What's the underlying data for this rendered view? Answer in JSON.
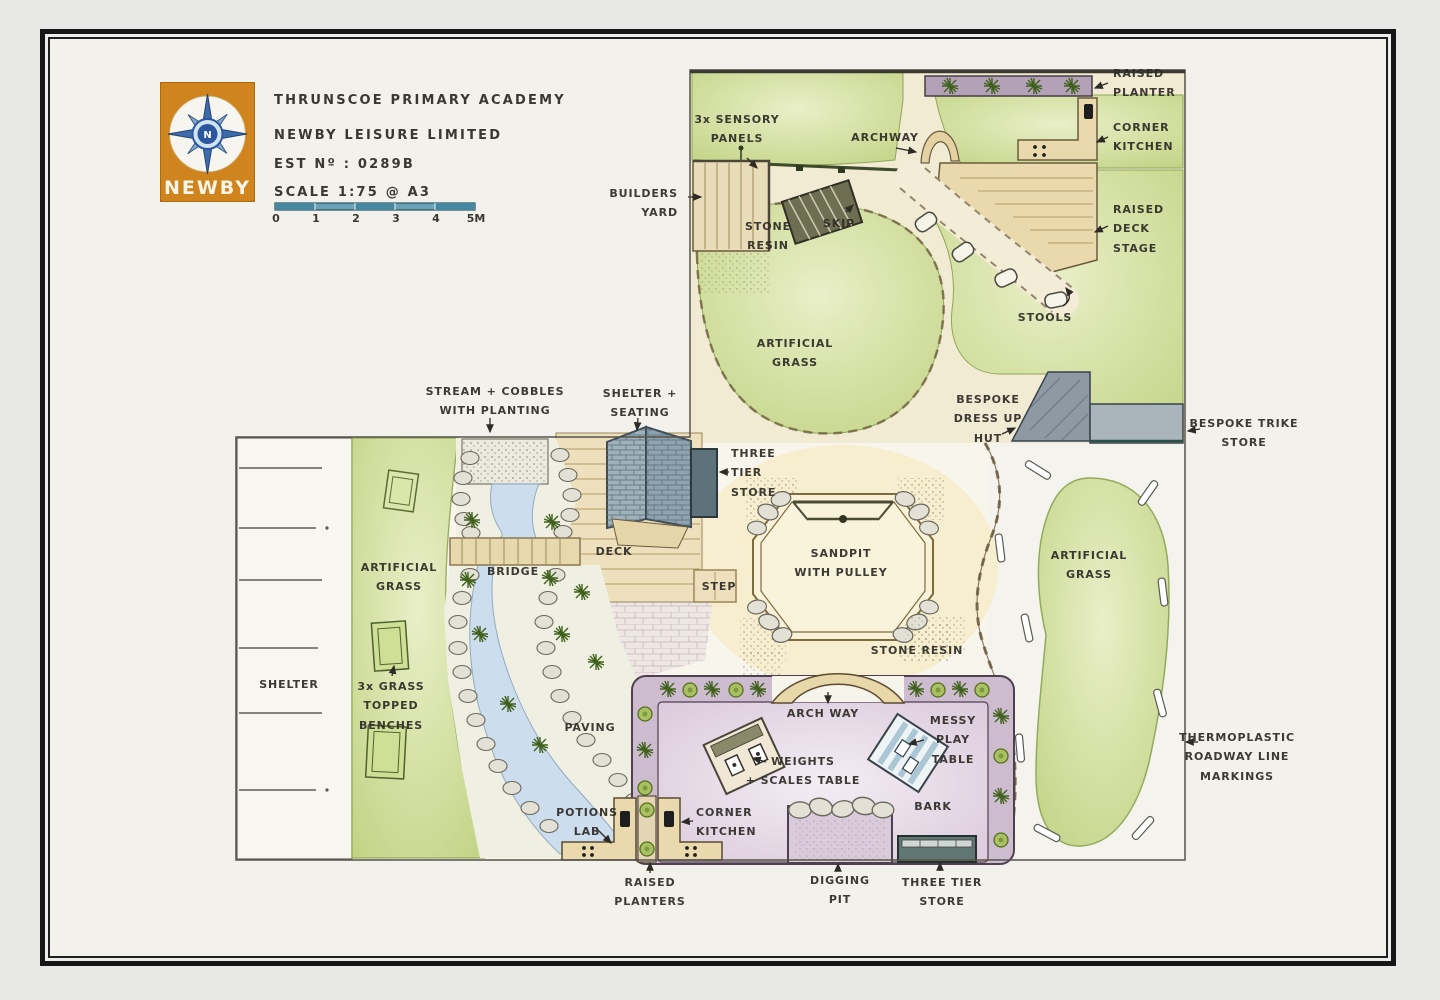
{
  "page": {
    "background": "#e8e8e6",
    "paper": "#f2f1ec",
    "frame_color": "#161616"
  },
  "title_block": {
    "logo_text": "NEWBY",
    "logo_letter": "N",
    "line1": "THRUNSCOE PRIMARY ACADEMY",
    "line2": "NEWBY LEISURE LIMITED",
    "line3": "EST Nº : 0289B",
    "line4": "SCALE 1:75 @ A3",
    "scale_ticks": [
      "0",
      "1",
      "2",
      "3",
      "4",
      "5M"
    ]
  },
  "colors": {
    "grass": "#cdda92",
    "grass_dark": "#8fa757",
    "stone_resin": "#f2ebd3",
    "wood": "#ead9ad",
    "bark_border": "#cdbccf",
    "bark_fill": "#ece0ed",
    "roof_slate": "#9fb2bc",
    "store_slate": "#5e727b",
    "store_teal": "#5f7673",
    "stream_blue": "#ccdded",
    "ink": "#2e2b26",
    "logo_orange": "#d0841e",
    "logo_blue": "#3d6cab",
    "scalebar_teal": "#4688a0"
  },
  "plan": {
    "labels": [
      {
        "id": "sensory-panels",
        "text": "3x SENSORY\nPANELS",
        "x": 737,
        "y": 110,
        "align": "center"
      },
      {
        "id": "archway-top",
        "text": "ARCHWAY",
        "x": 885,
        "y": 128,
        "align": "center"
      },
      {
        "id": "raised-planter",
        "text": "RAISED\nPLANTER",
        "x": 1113,
        "y": 64,
        "align": "left"
      },
      {
        "id": "corner-kitchen-top",
        "text": "CORNER\nKITCHEN",
        "x": 1113,
        "y": 118,
        "align": "left"
      },
      {
        "id": "raised-deck-stage",
        "text": "RAISED\nDECK\nSTAGE",
        "x": 1113,
        "y": 200,
        "align": "left"
      },
      {
        "id": "builders-yard",
        "text": "BUILDERS\nYARD",
        "x": 678,
        "y": 184,
        "align": "right"
      },
      {
        "id": "stone-resin-top",
        "text": "STONE\nRESIN",
        "x": 768,
        "y": 217,
        "align": "center"
      },
      {
        "id": "skip",
        "text": "SKIP",
        "x": 839,
        "y": 214,
        "align": "center"
      },
      {
        "id": "stools",
        "text": "STOOLS",
        "x": 1045,
        "y": 308,
        "align": "center"
      },
      {
        "id": "artificial-grass-top",
        "text": "ARTIFICIAL\nGRASS",
        "x": 795,
        "y": 334,
        "align": "center"
      },
      {
        "id": "dress-up-hut",
        "text": "BESPOKE\nDRESS UP\nHUT",
        "x": 988,
        "y": 390,
        "align": "center"
      },
      {
        "id": "trike-store",
        "text": "BESPOKE TRIKE\nSTORE",
        "x": 1244,
        "y": 414,
        "align": "center"
      },
      {
        "id": "stream-cobbles",
        "text": "STREAM + COBBLES\nWITH PLANTING",
        "x": 495,
        "y": 382,
        "align": "center"
      },
      {
        "id": "shelter-seating",
        "text": "SHELTER +\nSEATING",
        "x": 640,
        "y": 384,
        "align": "center"
      },
      {
        "id": "three-tier-store-top",
        "text": "THREE\nTIER\nSTORE",
        "x": 731,
        "y": 444,
        "align": "left"
      },
      {
        "id": "deck",
        "text": "DECK",
        "x": 614,
        "y": 542,
        "align": "center"
      },
      {
        "id": "step",
        "text": "STEP",
        "x": 719,
        "y": 577,
        "align": "center"
      },
      {
        "id": "sandpit",
        "text": "SANDPIT\nWITH PULLEY",
        "x": 841,
        "y": 544,
        "align": "center"
      },
      {
        "id": "artificial-grass-right",
        "text": "ARTIFICIAL\nGRASS",
        "x": 1089,
        "y": 546,
        "align": "center"
      },
      {
        "id": "bridge",
        "text": "BRIDGE",
        "x": 513,
        "y": 562,
        "align": "center"
      },
      {
        "id": "stone-resin-mid",
        "text": "STONE RESIN",
        "x": 917,
        "y": 641,
        "align": "center"
      },
      {
        "id": "shelter-left",
        "text": "SHELTER",
        "x": 289,
        "y": 675,
        "align": "center"
      },
      {
        "id": "artificial-grass-left",
        "text": "ARTIFICIAL\nGRASS",
        "x": 399,
        "y": 558,
        "align": "center"
      },
      {
        "id": "grass-benches",
        "text": "3x GRASS\nTOPPED\nBENCHES",
        "x": 391,
        "y": 677,
        "align": "center"
      },
      {
        "id": "paving",
        "text": "PAVING",
        "x": 590,
        "y": 718,
        "align": "center"
      },
      {
        "id": "archway-bottom",
        "text": "ARCH WAY",
        "x": 823,
        "y": 704,
        "align": "center"
      },
      {
        "id": "messy-play-table",
        "text": "MESSY\nPLAY\nTABLE",
        "x": 953,
        "y": 711,
        "align": "center"
      },
      {
        "id": "weights-scales-table",
        "text": "WEIGHTS\n+ SCALES TABLE",
        "x": 803,
        "y": 752,
        "align": "center"
      },
      {
        "id": "potions-lab",
        "text": "POTIONS\nLAB",
        "x": 587,
        "y": 803,
        "align": "center"
      },
      {
        "id": "corner-kitchen-bottom",
        "text": "CORNER\nKITCHEN",
        "x": 696,
        "y": 803,
        "align": "left"
      },
      {
        "id": "bark",
        "text": "BARK",
        "x": 933,
        "y": 797,
        "align": "center"
      },
      {
        "id": "raised-planters",
        "text": "RAISED\nPLANTERS",
        "x": 650,
        "y": 873,
        "align": "center"
      },
      {
        "id": "digging-pit",
        "text": "DIGGING\nPIT",
        "x": 840,
        "y": 871,
        "align": "center"
      },
      {
        "id": "three-tier-store-bottom",
        "text": "THREE TIER\nSTORE",
        "x": 942,
        "y": 873,
        "align": "center"
      },
      {
        "id": "thermoplastic",
        "text": "THERMOPLASTIC\nROADWAY LINE\nMARKINGS",
        "x": 1237,
        "y": 728,
        "align": "center"
      }
    ]
  }
}
